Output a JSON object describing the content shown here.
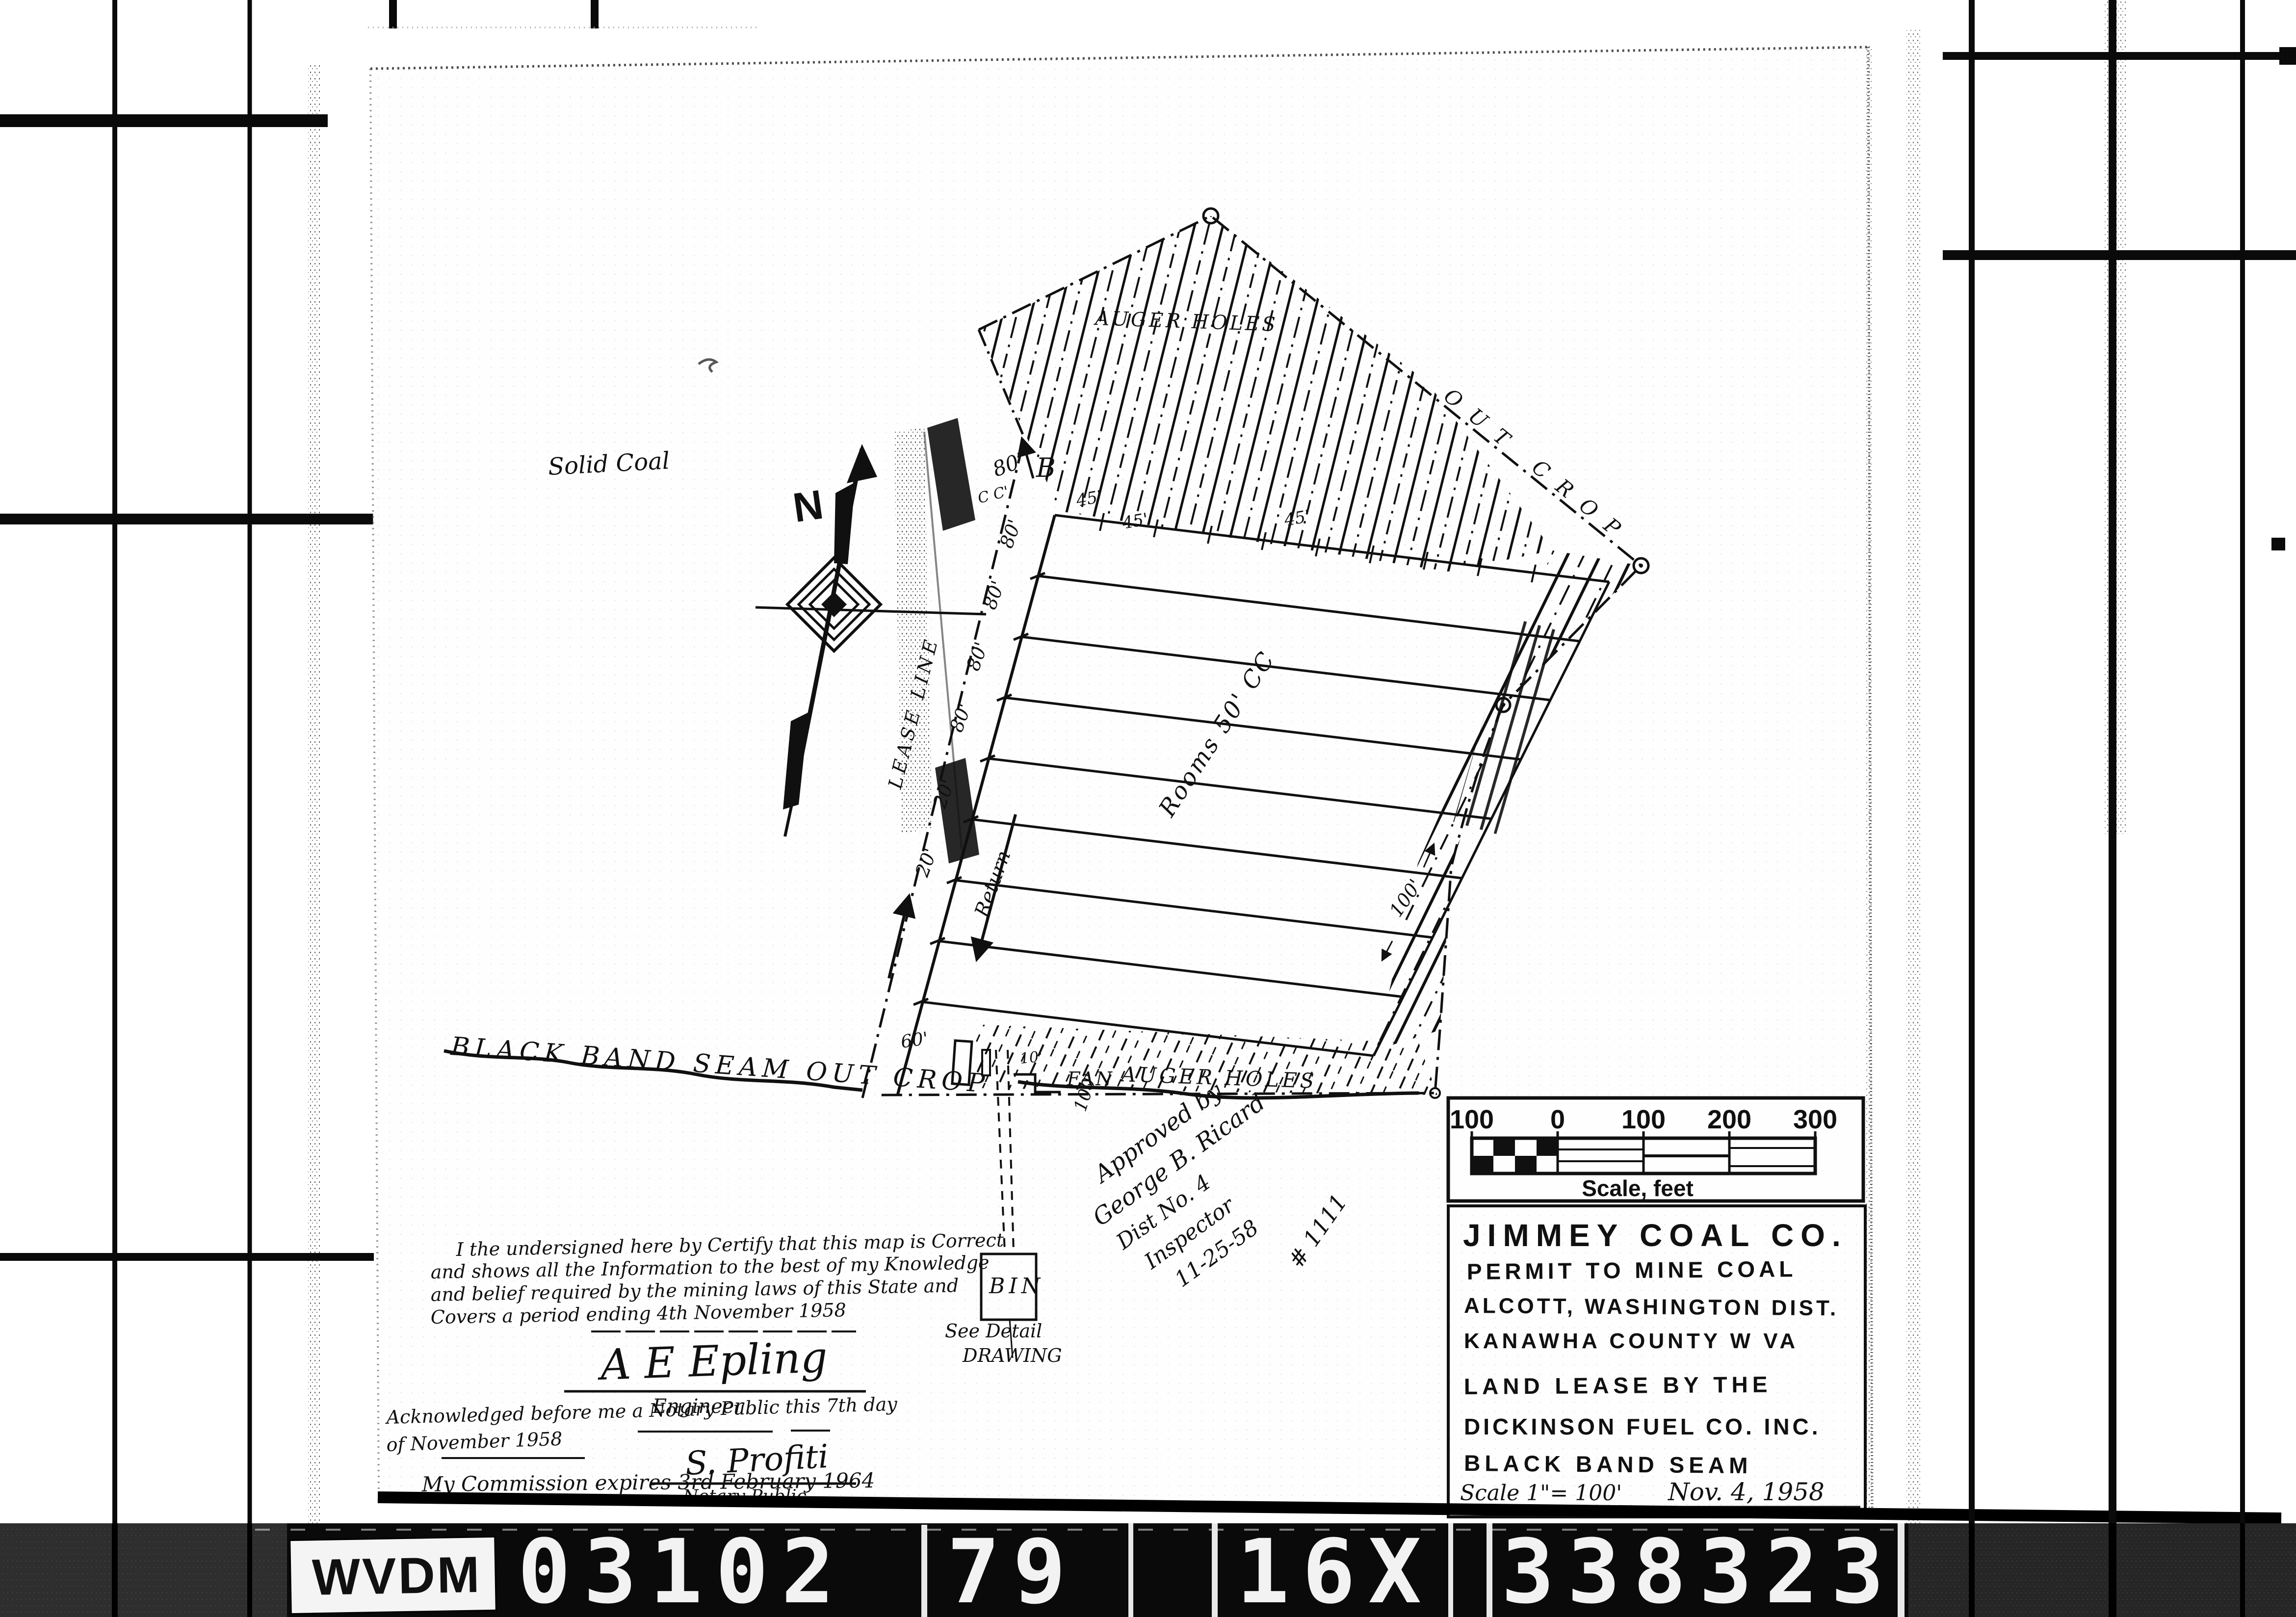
{
  "colors": {
    "ink": "#101010",
    "paper": "#fefefe",
    "film_bar": "#0a0a0a",
    "label_bg": "#f4f4f4"
  },
  "film_bar": {
    "agency_label": "WVDM",
    "reel_number": "03102",
    "frame_number": "79",
    "reduction": "16X",
    "document_number": "338323"
  },
  "map": {
    "labels": {
      "solid_coal": "Solid Coal",
      "north": "N",
      "lease_line": "LEASE LINE",
      "point_b": "B",
      "outcrop_long": "BLACK BAND SEAM OUT CROP",
      "outcrop_short": "OUT CROP",
      "auger_holes_top": "AUGER HOLES",
      "auger_holes_bottom": "AUGER HOLES",
      "rooms": "Rooms 50' CC",
      "return_airway": "Return",
      "fan": "FAN",
      "bin": "BIN",
      "see_detail_1": "See Detail",
      "see_detail_2": "DRAWING"
    },
    "dimensions": {
      "top_80": "80'",
      "top_cc": "C C'",
      "room_45_a": "45'",
      "room_45_b": "45'",
      "room_45_c": "45'",
      "m80_a": "80'",
      "m80_b": "80'",
      "m80_c": "80'",
      "m80_d": "80'",
      "m20_a": "20'",
      "m20_b": "20'",
      "auger_100_a": "100'",
      "auger_100_b": "100'",
      "portal_10": "10'",
      "outcrop_60": "60'"
    },
    "scale_bar": {
      "tick_1": "100",
      "tick_2": "0",
      "tick_3": "100",
      "tick_4": "200",
      "tick_5": "300",
      "caption": "Scale, feet"
    },
    "title_block": {
      "company": "JIMMEY COAL CO.",
      "line_2": "PERMIT TO MINE COAL",
      "line_3": "ALCOTT, WASHINGTON DIST.",
      "line_4": "KANAWHA COUNTY  W VA",
      "line_5": "LAND LEASE BY THE",
      "line_6": "DICKINSON FUEL CO. INC.",
      "line_7": "BLACK BAND SEAM",
      "scale_note": "Scale 1\"= 100'",
      "date": "Nov. 4, 1958"
    },
    "certification": {
      "line_1": "I the undersigned here by Certify that this map is Correct",
      "line_2": "and shows all the Information to the best of my Knowledge",
      "line_3": "and belief required by the mining laws of this State and",
      "line_4": "Covers a period ending 4th November 1958",
      "engineer_signature": "A E Epling",
      "engineer_label": "Engineer",
      "ack_line_1": "Acknowledged before me a Notary Public this 7th day",
      "ack_line_2": "of November 1958",
      "notary_signature": "S. Profiti",
      "notary_label": "Notary Public",
      "commission": "My Commission expires 3rd February 1964"
    },
    "approval": {
      "line_1": "Approved by",
      "line_2": "George B. Ricard",
      "line_3": "Dist No. 4",
      "line_4": "Inspector",
      "line_5": "11-25-58",
      "line_6": "# 1111"
    }
  }
}
